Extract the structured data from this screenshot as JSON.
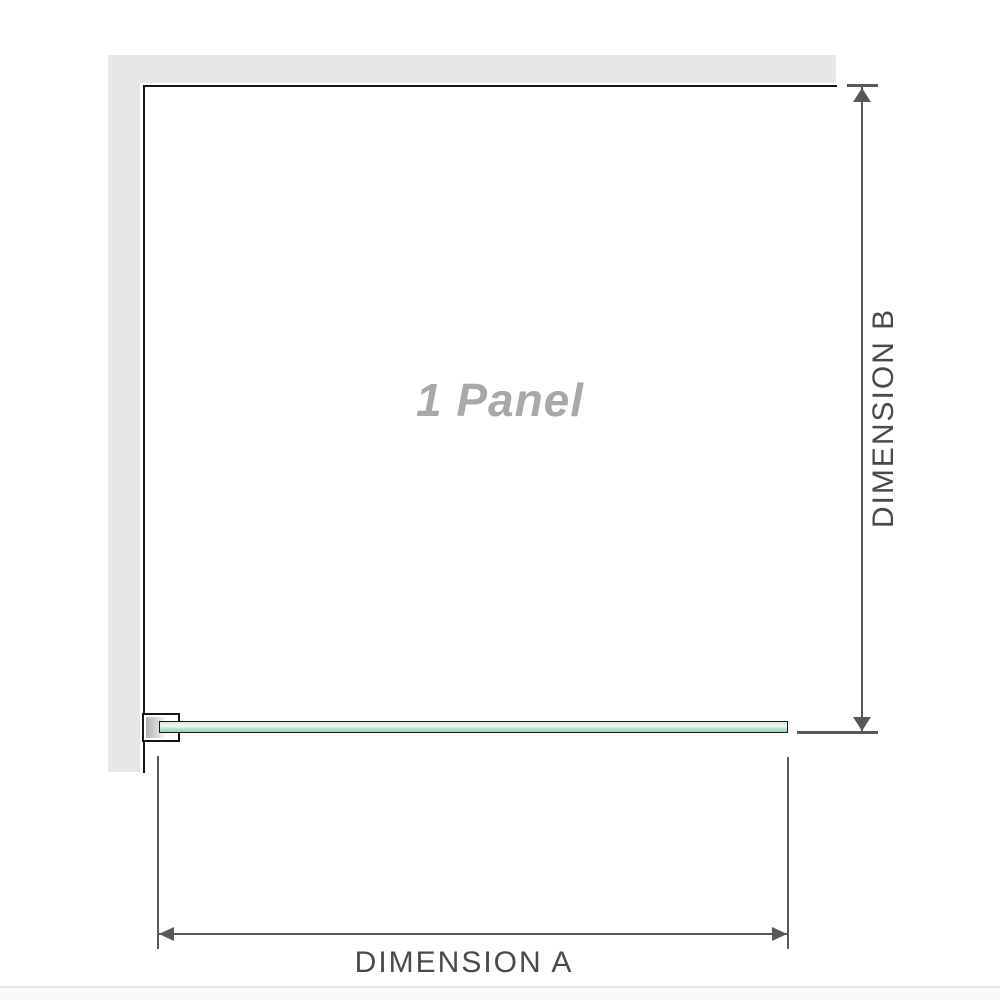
{
  "diagram": {
    "type": "shower-screen dimension diagram",
    "panel_label": "1 Panel",
    "dimension_a_label": "DIMENSION A",
    "dimension_b_label": "DIMENSION B"
  },
  "colors": {
    "wall_fill": "#e7e7e7",
    "wall_edge": "#151515",
    "dimension_line": "#58585a",
    "dimension_text": "#4a4a4c",
    "panel_label_text": "#a8a8a8",
    "glass_outline": "#1a1a1a",
    "glass_light": "#e9f6ee",
    "glass_mid": "#bce5cb",
    "glass_dark": "#98d4b1",
    "glass_top": "#cdebd9",
    "bracket_fill": "#ffffff",
    "bracket_inner_dark": "#b2b2b2",
    "bracket_inner_light": "#f0f0f0",
    "divider": "#e3e3e0",
    "footer_fill": "#fafaf8"
  }
}
